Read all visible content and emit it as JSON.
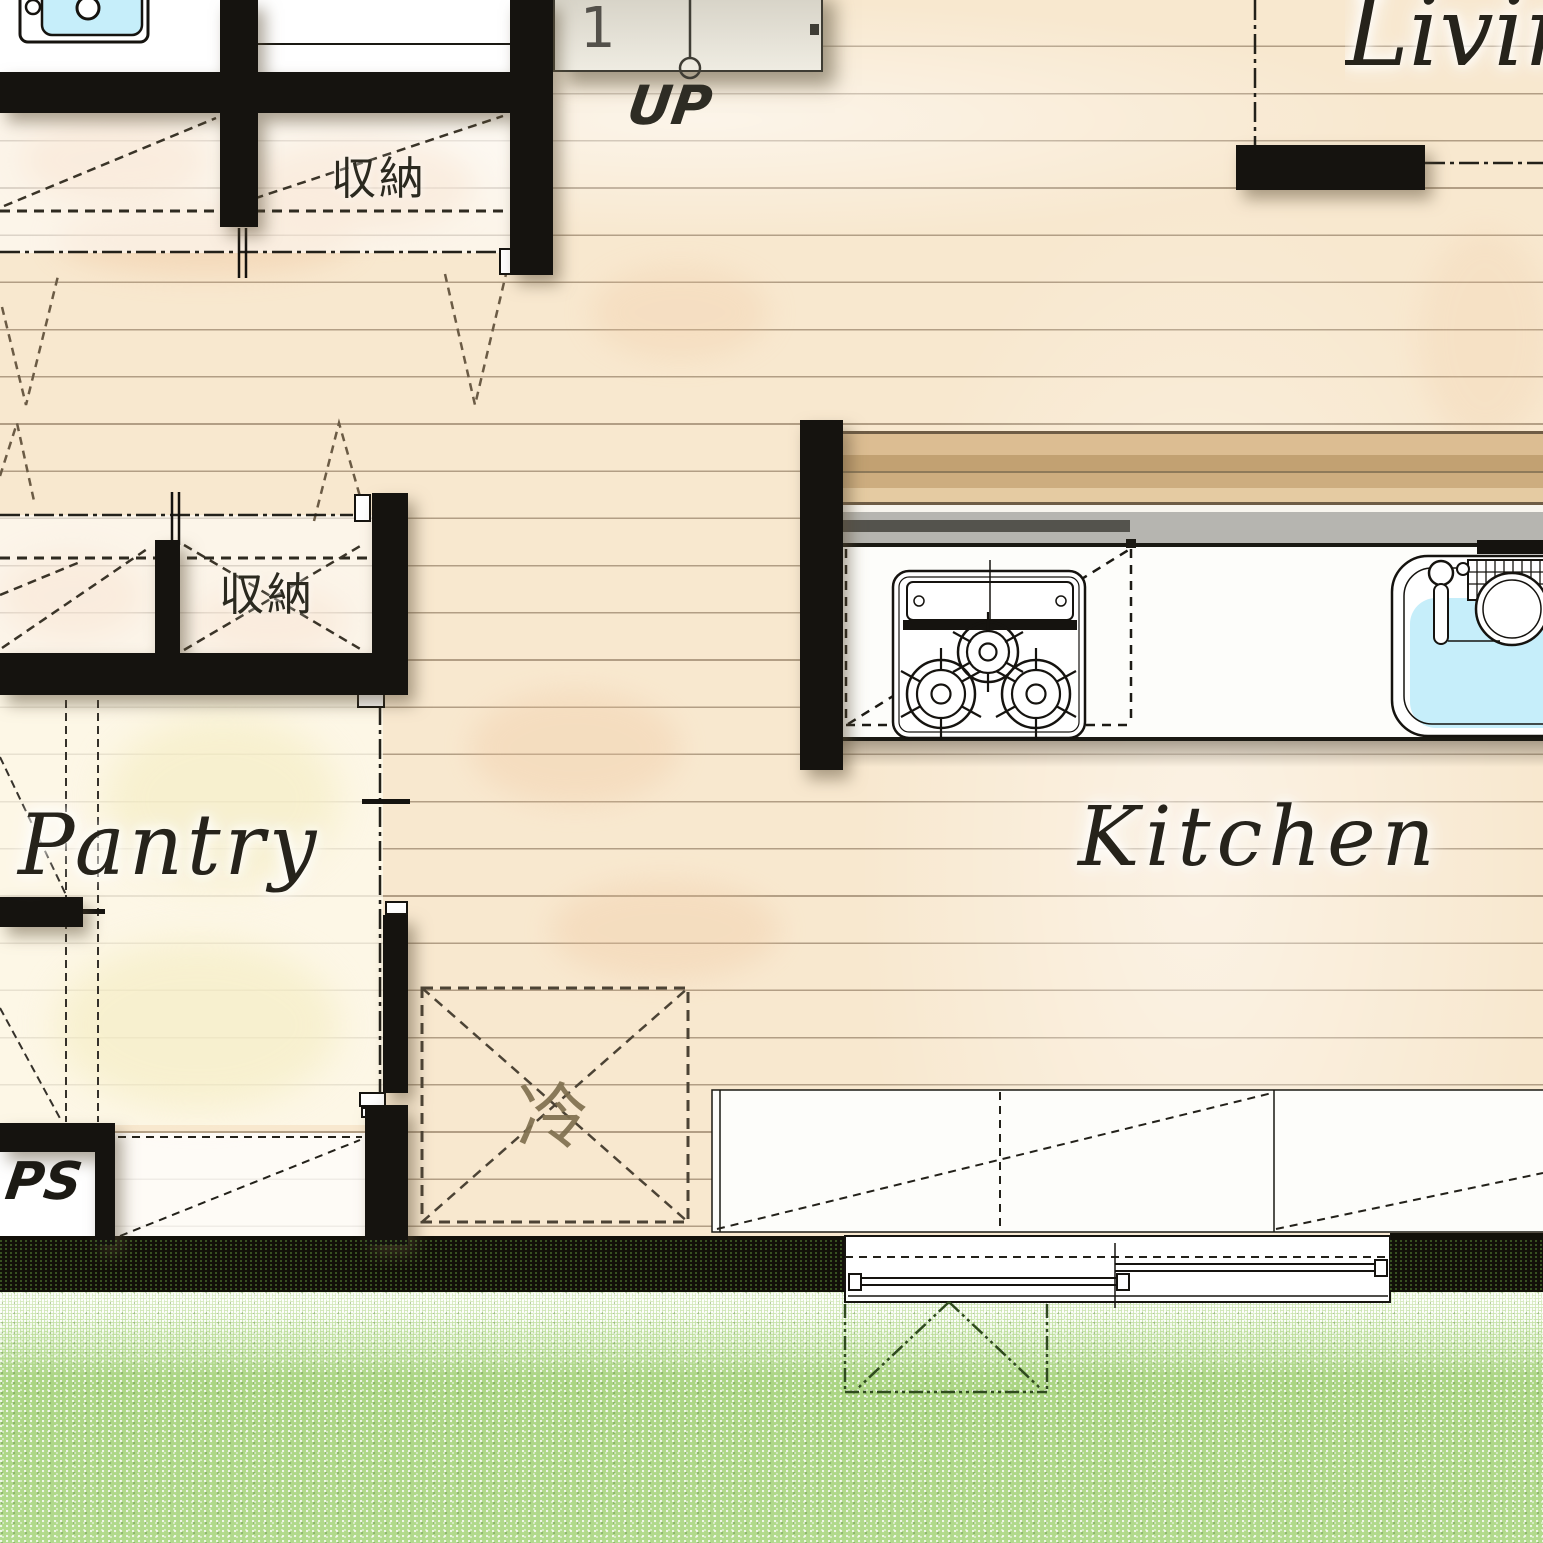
{
  "plan": {
    "type": "japanese house floor plan (1F, partial crop)",
    "rooms": [
      {
        "id": "living",
        "label": "Living"
      },
      {
        "id": "kitchen",
        "label": "Kitchen"
      },
      {
        "id": "pantry",
        "label": "Pantry"
      },
      {
        "id": "closet-top",
        "label": "収納"
      },
      {
        "id": "closet-mid",
        "label": "収納"
      },
      {
        "id": "pipe-space",
        "label": "PS"
      }
    ],
    "annotations": {
      "up": "UP",
      "stair_step_number": "1",
      "refrigerator": "冷"
    },
    "fixtures": [
      "vanity-sink",
      "staircase-first-step",
      "gas-stove-3-burners",
      "kitchen-sink",
      "refrigerator-space",
      "bar-counter",
      "low-cabinet",
      "sliding-window",
      "lawn-garden"
    ],
    "colors": {
      "wood_floor": "#f8e8cf",
      "plank_line": "#78624a",
      "wall": "#15130f",
      "lawn_green": "#aed787",
      "water_cyan": "#c6eefa",
      "bar_counter_tan": "#c2a172",
      "counter_gray": "#b6b5b0",
      "pantry_floor": "#fbf8e8",
      "floor_blotch": "#eec49c"
    }
  }
}
